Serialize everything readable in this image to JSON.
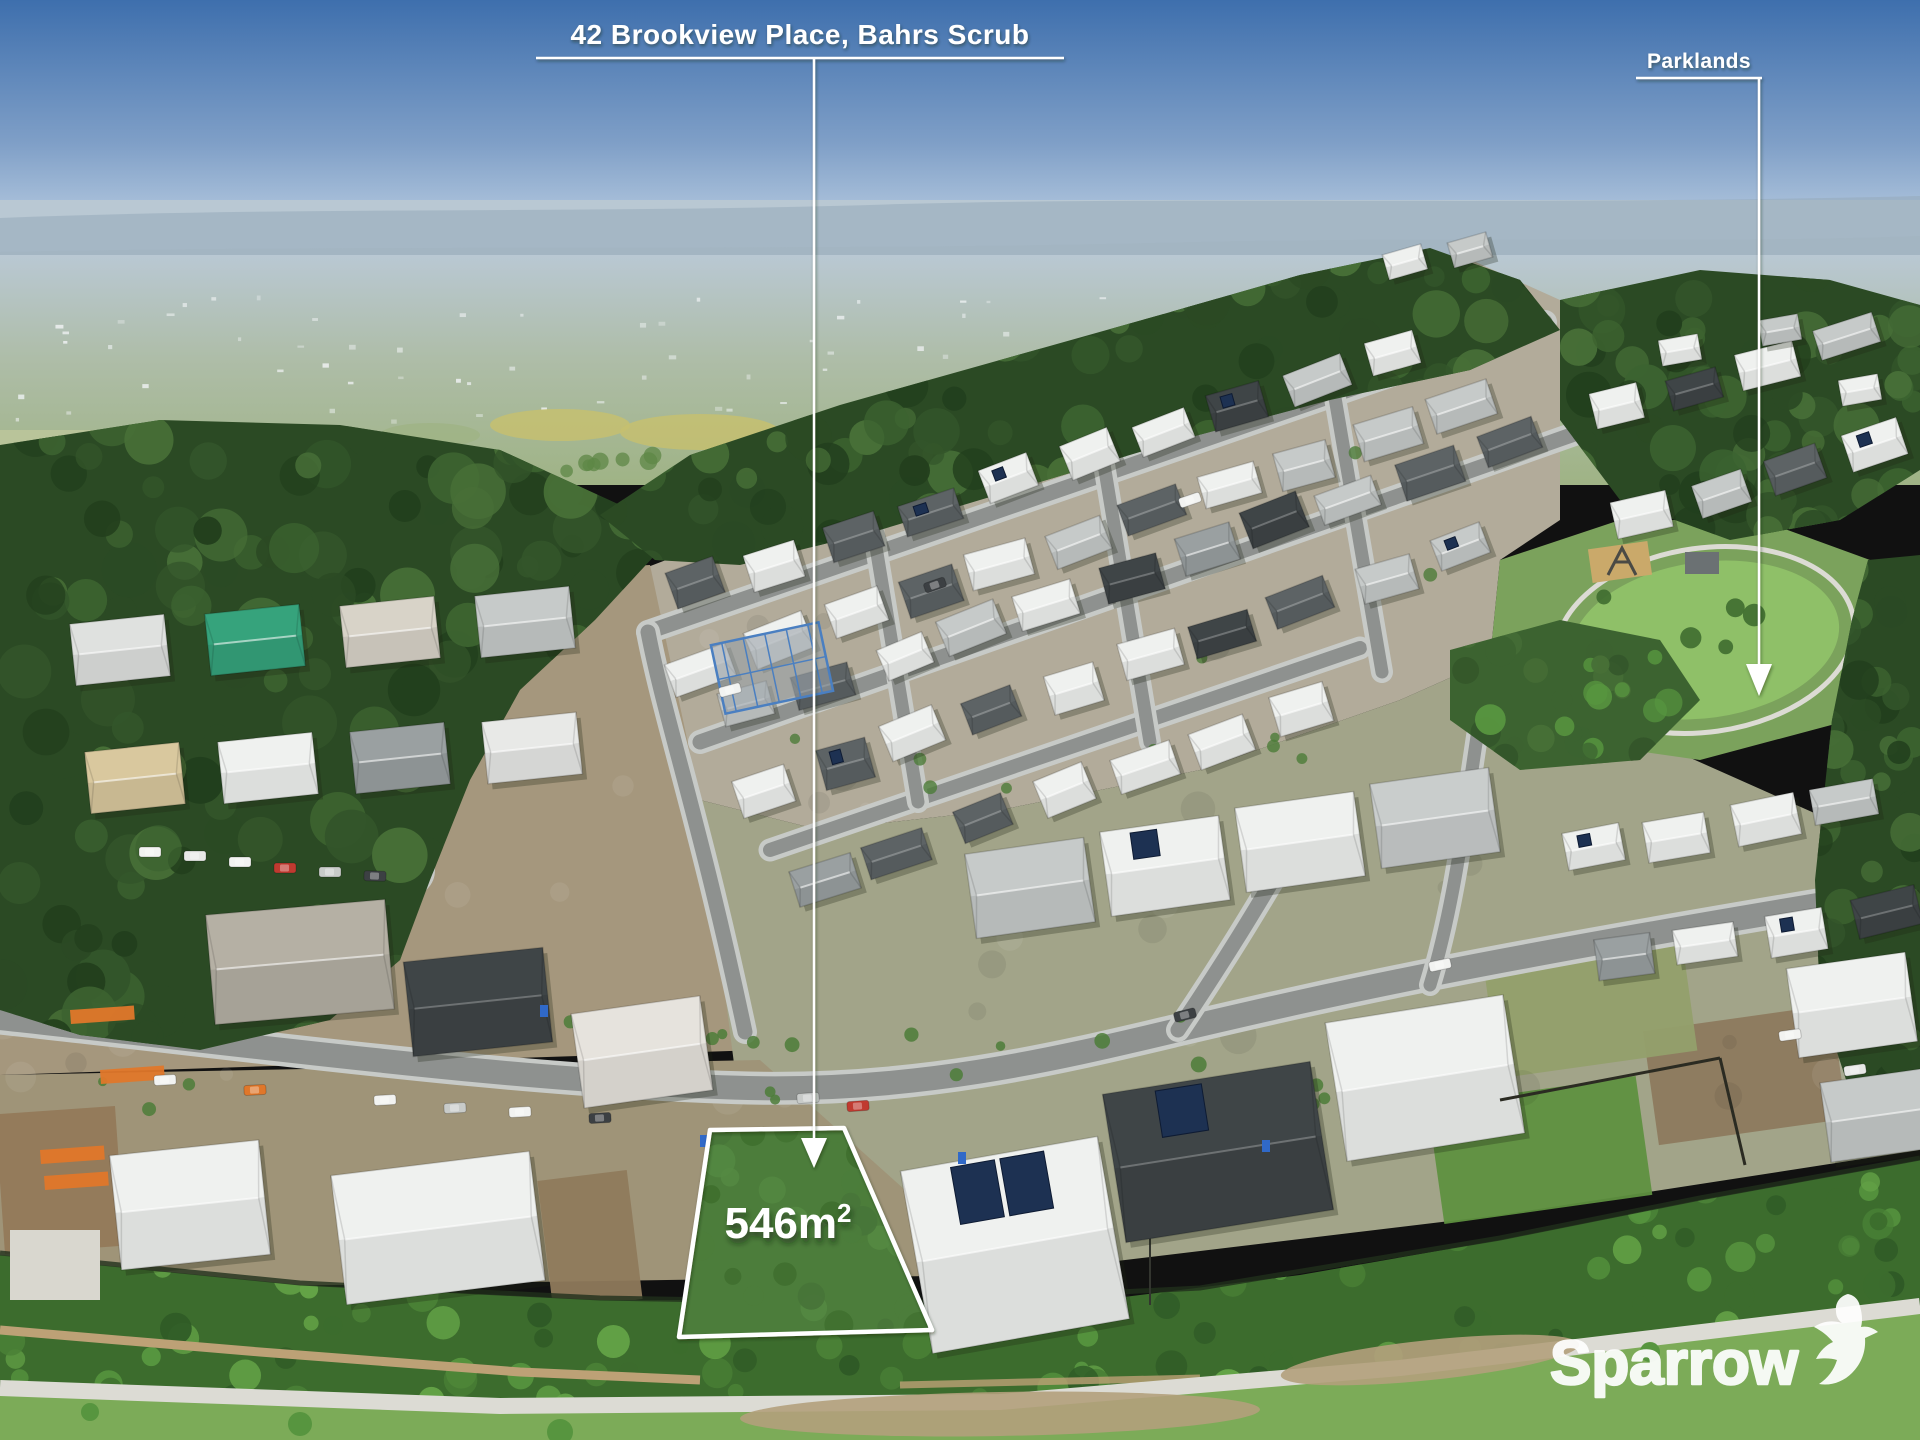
{
  "annotations": {
    "title": "42 Brookview Place, Bahrs Scrub",
    "parklands": "Parklands",
    "lot_area": "546m",
    "lot_area_sup": "2",
    "logo_text": "Sparrow"
  },
  "colors": {
    "annotation": "#ffffff",
    "sky_top": "#3e6fad",
    "sky_mid": "#7f9fc7",
    "sky_horizon": "#cadae9",
    "haze": "#b9c8d3",
    "ridge": "#95a9ba",
    "plain": "#a9b9a0",
    "field_green": "#9fb385",
    "field_yellow": "#c6bf70",
    "treeline": "#5d8746",
    "forest_palette": [
      "#223f1d",
      "#2b4a24",
      "#33552a",
      "#3c6330",
      "#476f37"
    ],
    "bush_palette": [
      "#2f5a26",
      "#3c6c2d",
      "#4a8136",
      "#57953f",
      "#64a347"
    ],
    "ground_estate": "#b2ab9a",
    "ground_mid": "#a5977d",
    "ground_low": "#a2a489",
    "dirt": "#93795a",
    "scrub": "#5f9140",
    "road": "#8e918f",
    "road_casing": "#c7cac7",
    "path": "#dcdbd4",
    "wall": "#bda176",
    "roof_white": "#eff1ef",
    "roof_light": "#c6cac9",
    "roof_mid": "#9aa0a1",
    "roof_dark": "#5d6365",
    "roof_charcoal": "#3f4547",
    "cream": "#d9c89e",
    "grass_lot": "#4c7d3b",
    "grass_park": "#8fc068",
    "park_bed": "#7ba25c",
    "grass_bottom": "#7cab58",
    "solar": "#1d3152",
    "teal": "#36a37c",
    "orange": "#e0772a",
    "red": "#c03a30",
    "blue": "#3069c8",
    "steel": "#4a7fc1"
  }
}
